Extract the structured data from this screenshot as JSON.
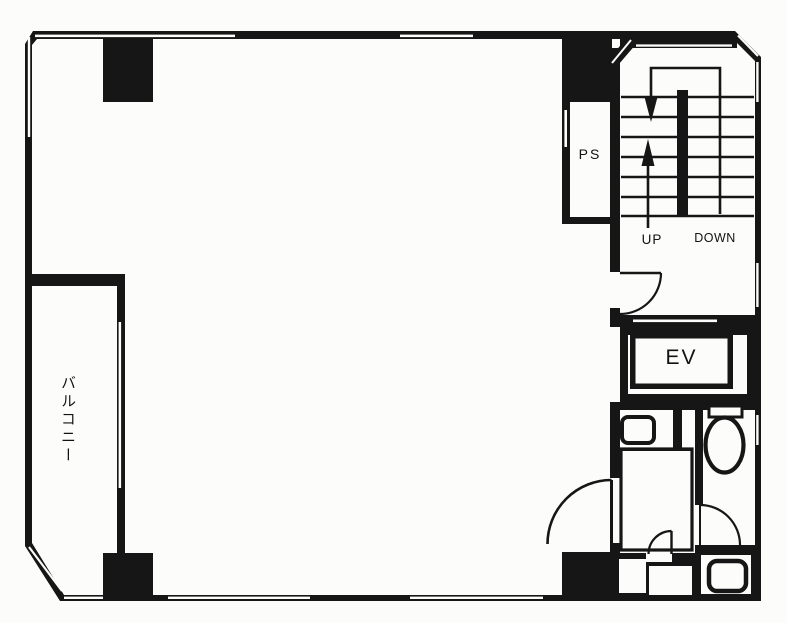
{
  "colors": {
    "ink": "#161616",
    "paper": "#fcfcfb"
  },
  "plan": {
    "labels": {
      "pipe_shaft": "PS",
      "stairs_up": "UP",
      "stairs_down": "DOWN",
      "elevator": "EV",
      "balcony": "バルコニー"
    },
    "icons": {
      "up_arrow": "arrow-up",
      "down_arrow": "arrow-down",
      "toilet": "toilet-bowl",
      "sink": "sink-basin",
      "door": "door-swing-arc"
    }
  }
}
